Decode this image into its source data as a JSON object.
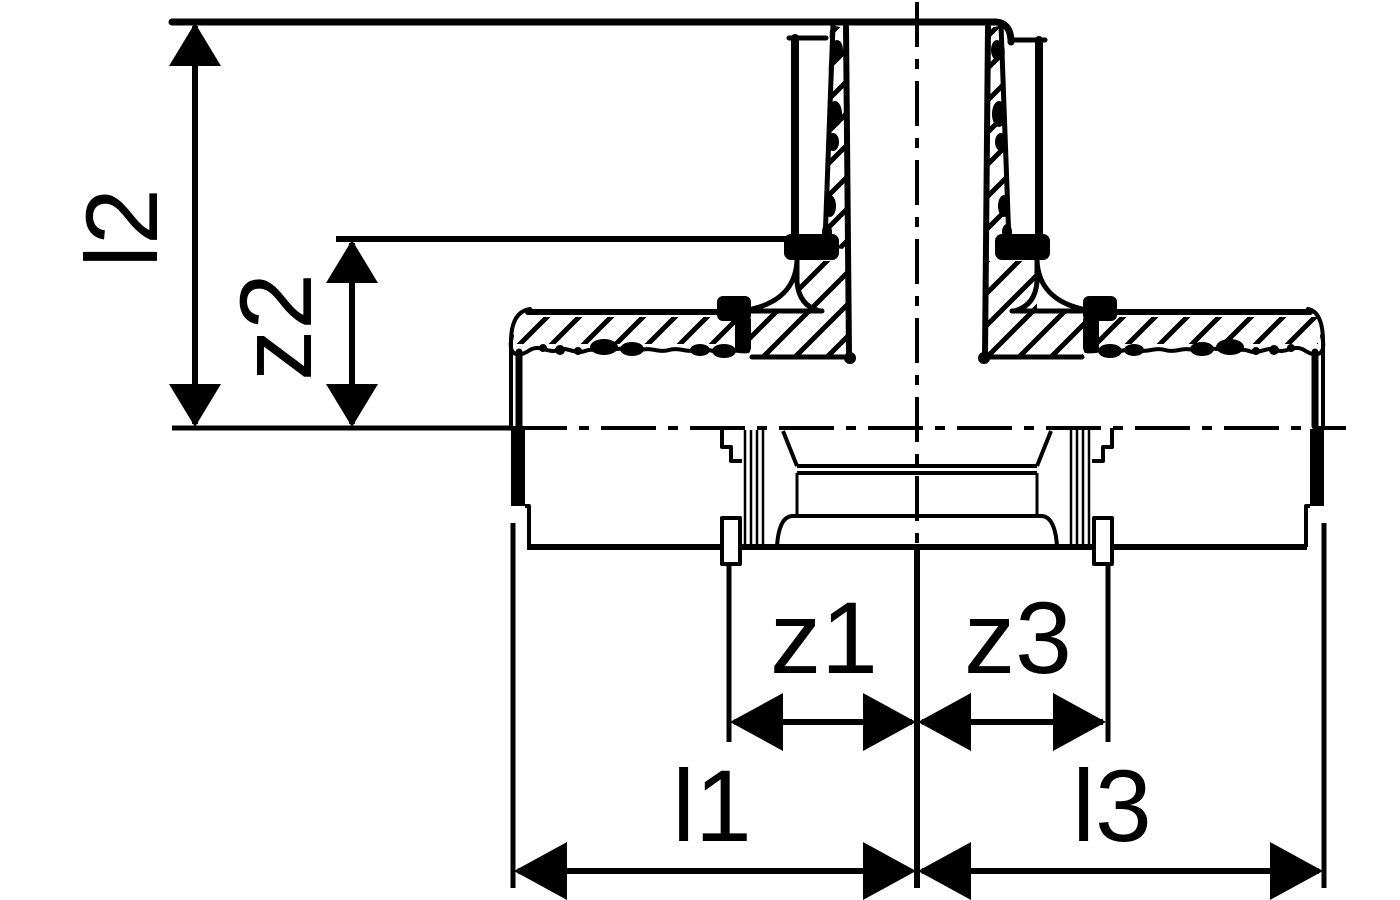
{
  "figure": {
    "type": "technical-drawing",
    "subject": "press-fitting tee cross-section with dimension lines",
    "background_color": "#ffffff",
    "line_color": "#000000"
  },
  "drawing": {
    "dimension_labels": {
      "l1": "l1",
      "l2": "l2",
      "l3": "l3",
      "z1": "z1",
      "z2": "z2",
      "z3": "z3"
    }
  }
}
